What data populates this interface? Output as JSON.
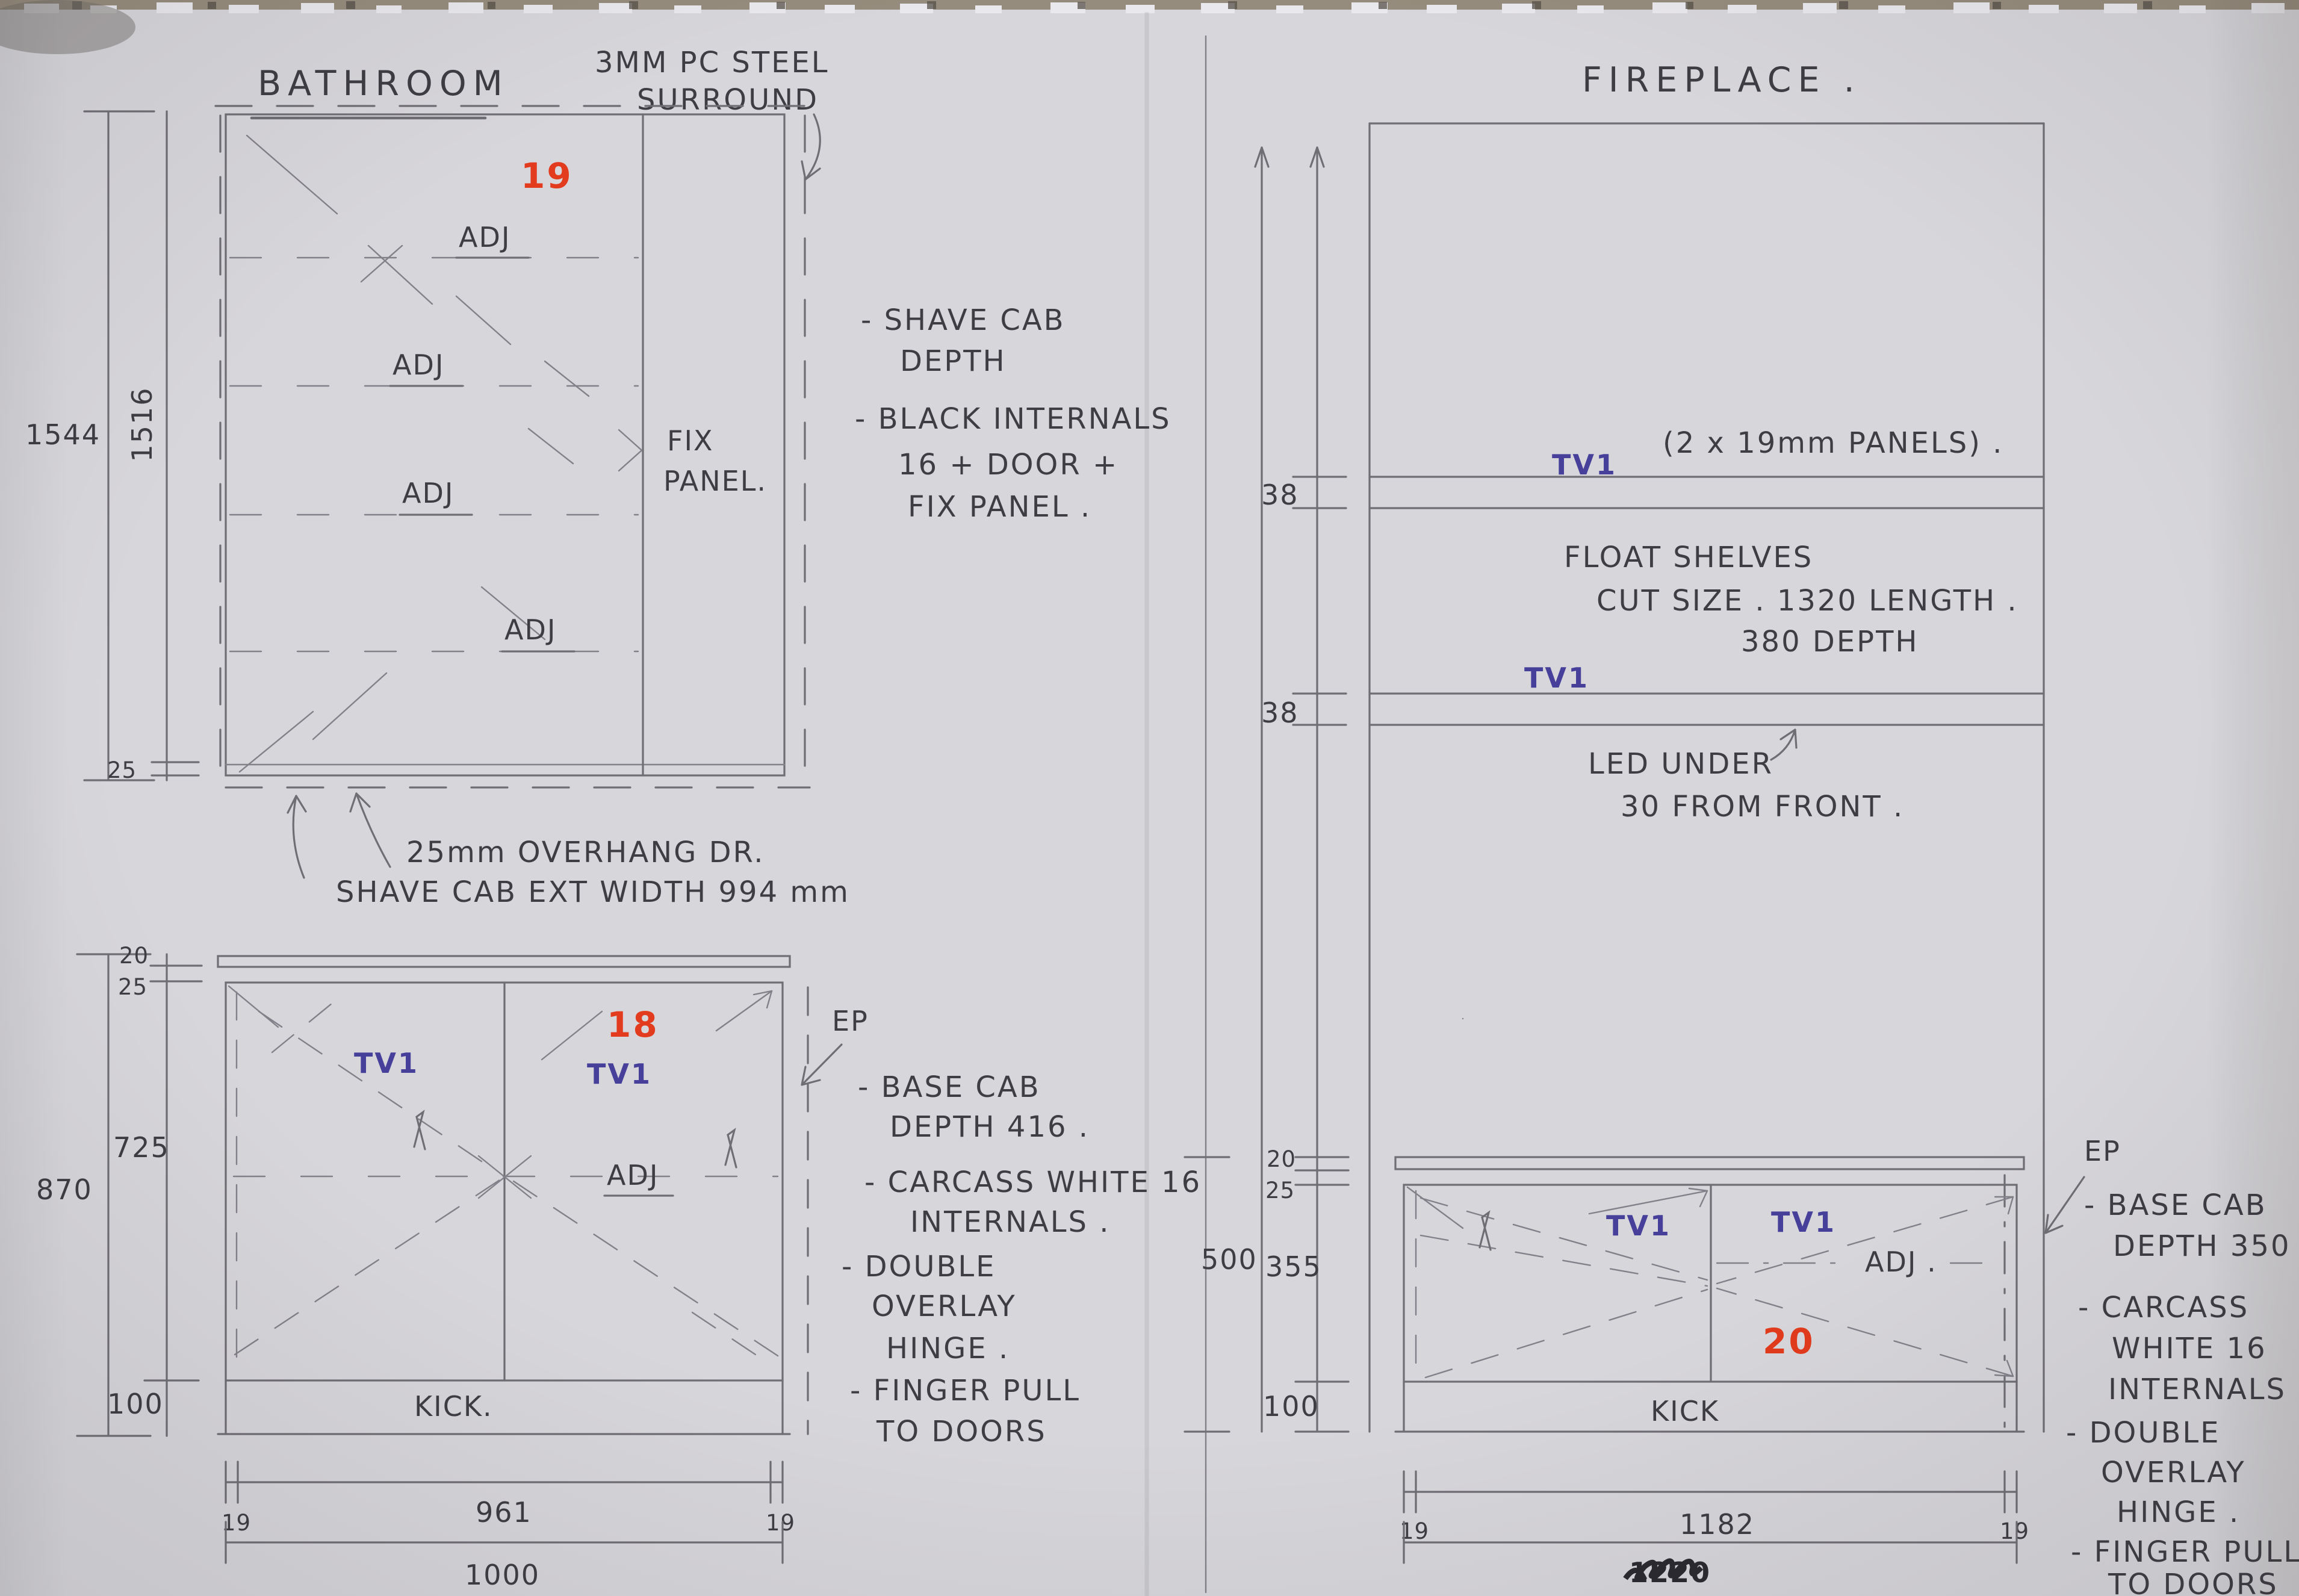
{
  "bathroom": {
    "title": "BATHROOM",
    "tall_cab": {
      "unit_number": "19",
      "surround_note": [
        "3MM PC STEEL",
        "SURROUND"
      ],
      "shelf_labels": [
        "ADJ",
        "ADJ",
        "ADJ",
        "ADJ"
      ],
      "fix_panel": [
        "FIX",
        "PANEL."
      ],
      "dim_overall_height": "1544",
      "dim_internal_height": "1516",
      "dim_door_overhang": "25",
      "overhang_note": [
        "25mm OVERHANG DR.",
        "SHAVE CAB EXT WIDTH 994 mm"
      ],
      "notes": [
        "- SHAVE CAB",
        "DEPTH",
        "- BLACK INTERNALS",
        "16 + DOOR +",
        "FIX PANEL ."
      ]
    },
    "base_cab": {
      "unit_number": "18",
      "door_labels": [
        "TV1",
        "TV1"
      ],
      "shelf_label": "ADJ",
      "end_panel_label": "EP",
      "kick_label": "KICK.",
      "dim_overall_height": "870",
      "dim_counter_thk": "20",
      "dim_counter_gap": "25",
      "dim_door_height": "725",
      "dim_kick": "100",
      "dim_left_panel": "19",
      "dim_internal_width": "961",
      "dim_right_panel": "19",
      "dim_overall_width": "1000",
      "notes": [
        "- BASE CAB",
        "DEPTH 416 .",
        "- CARCASS WHITE 16",
        "INTERNALS .",
        "- DOUBLE",
        "OVERLAY",
        "HINGE .",
        "- FINGER PULL",
        "TO DOORS"
      ]
    }
  },
  "fireplace": {
    "title": "FIREPLACE .",
    "shelves": {
      "tv_labels": [
        "TV1",
        "TV1"
      ],
      "panels_note": "(2 x 19mm PANELS) .",
      "dim_shelf_thk": [
        "38",
        "38"
      ],
      "float_note": [
        "FLOAT SHELVES",
        "CUT SIZE .  1320 LENGTH .",
        "380 DEPTH"
      ],
      "led_note": [
        "LED UNDER",
        "30 FROM FRONT ."
      ]
    },
    "base_cab": {
      "unit_number": "20",
      "door_labels": [
        "TV1",
        "TV1"
      ],
      "shelf_label": "ADJ .",
      "end_panel_label": "EP",
      "kick_label": "KICK",
      "dim_overall_height": "500",
      "dim_counter_thk": "20",
      "dim_counter_gap": "25",
      "dim_door_height": "355",
      "dim_kick": "100",
      "dim_left_panel": "19",
      "dim_internal_width": "1182",
      "dim_right_panel": "19",
      "dim_overall_width_scribbled": "1220",
      "notes": [
        "- BASE CAB",
        "DEPTH 350 .",
        "- CARCASS",
        "WHITE 16",
        "INTERNALS .",
        "- DOUBLE",
        "OVERLAY",
        "HINGE .",
        "- FINGER PULL",
        "TO DOORS"
      ]
    }
  },
  "colors": {
    "paper": "#d7d6da",
    "pencil": "#6f6e74",
    "handwriting": "#3e3d44",
    "blue_ink": "#46409a",
    "red_ink": "#e23b1d",
    "scribble_ink": "#2b2a30"
  }
}
